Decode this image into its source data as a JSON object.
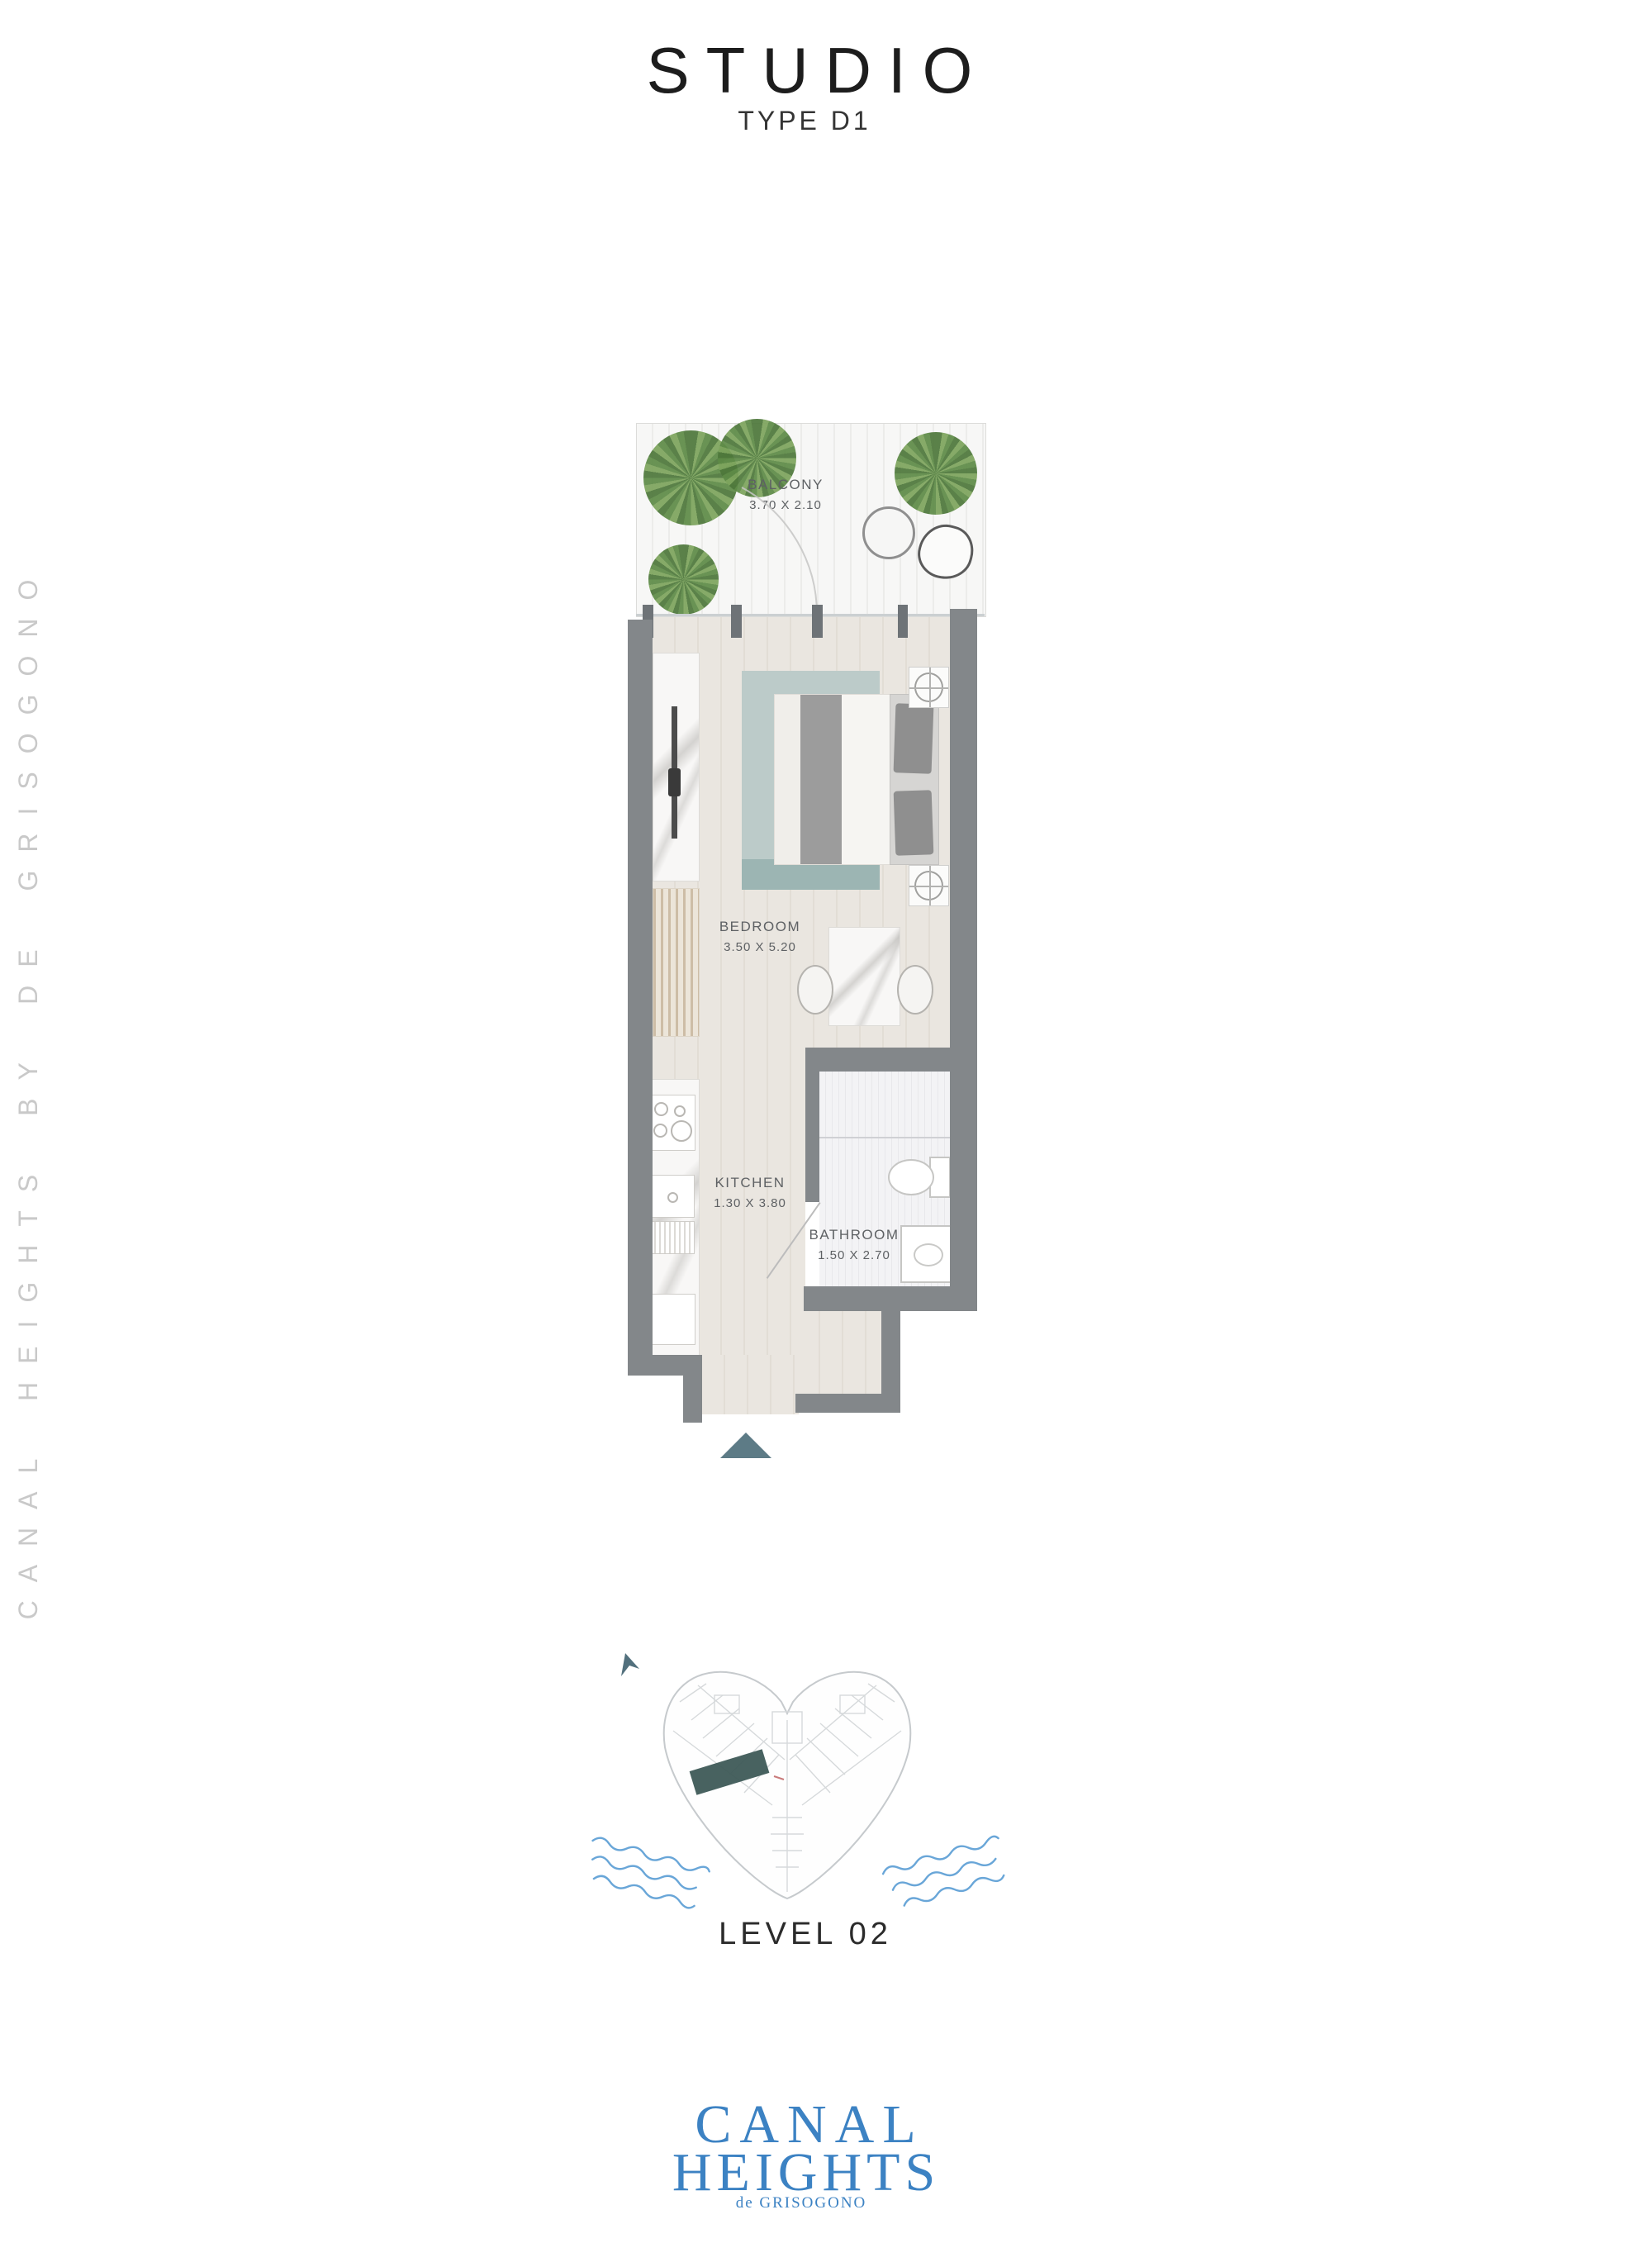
{
  "page": {
    "title": "STUDIO",
    "subtitle": "TYPE D1",
    "side_text": "CANAL HEIGHTS BY DE GRISOGONO",
    "level_label": "LEVEL 02"
  },
  "floor_plan": {
    "rooms": [
      {
        "name": "BALCONY",
        "dimensions": "3.70 X 2.10"
      },
      {
        "name": "BEDROOM",
        "dimensions": "3.50 X 5.20"
      },
      {
        "name": "KITCHEN",
        "dimensions": "1.30 X 3.80"
      },
      {
        "name": "BATHROOM",
        "dimensions": "1.50 X 2.70"
      }
    ]
  },
  "logo": {
    "line1": "CANAL",
    "line2": "HEIGHTS",
    "line3": "de GRISOGONO"
  },
  "colors": {
    "wall": "#83878a",
    "floor": "#eae6e0",
    "floor_stripe": "#e2ddd5",
    "accent": "#5d7b86",
    "rug": "#bccbc9",
    "rug_dark": "#9cb5b3",
    "highlight": "#3e5a57",
    "water": "#69a6d8",
    "logo_blue": "#3c82c3",
    "side_text": "#c9c9c9",
    "label": "#5e6164",
    "title": "#1d1d1d"
  }
}
